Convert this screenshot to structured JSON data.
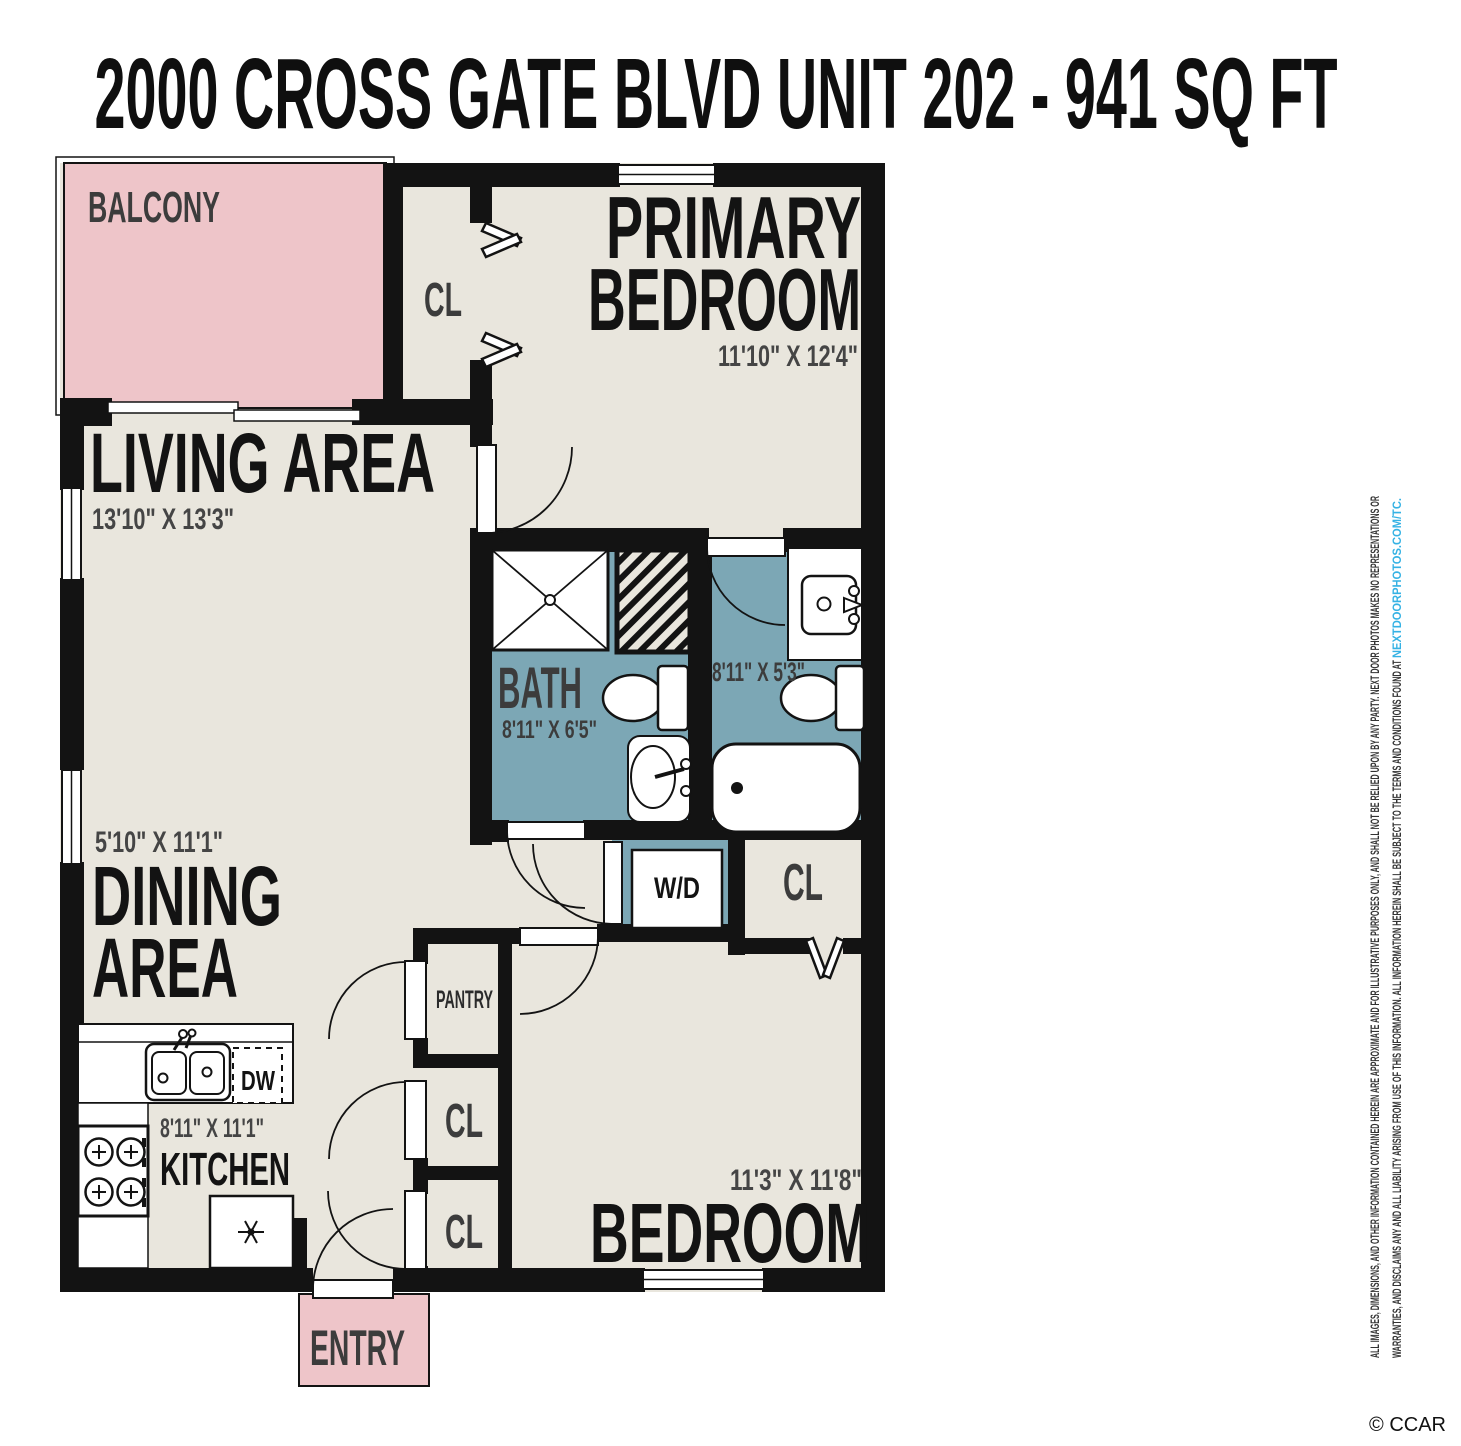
{
  "title": "2000 CROSS GATE BLVD UNIT 202 - 941 SQ FT",
  "floorplan": {
    "rooms": {
      "balcony": {
        "label": "BALCONY"
      },
      "closet_primary": {
        "label": "CL"
      },
      "primary_bedroom": {
        "line1": "PRIMARY",
        "line2": "BEDROOM",
        "dims": "11'10\" X 12'4\""
      },
      "living_area": {
        "label": "LIVING AREA",
        "dims": "13'10\" X 13'3\""
      },
      "bath": {
        "label": "BATH",
        "dims": "8'11\" X 6'5\""
      },
      "ensuite_bath": {
        "dims": "8'11\" X 5'3\""
      },
      "washer_dryer": {
        "label": "W/D"
      },
      "hall_closet": {
        "label": "CL"
      },
      "dining_area": {
        "line1": "DINING",
        "line2": "AREA",
        "dims": "5'10\" X 11'1\""
      },
      "pantry": {
        "label": "PANTRY"
      },
      "closet_1": {
        "label": "CL"
      },
      "closet_2": {
        "label": "CL"
      },
      "kitchen": {
        "label": "KITCHEN",
        "dims": "8'11\" X 11'1\""
      },
      "dishwasher": {
        "label": "DW"
      },
      "bedroom": {
        "label": "BEDROOM",
        "dims": "11'3\" X 11'8\""
      },
      "entry": {
        "label": "ENTRY"
      }
    },
    "colors": {
      "floor": "#e9e6dd",
      "wall": "#131313",
      "balcony_fill": "#eec5c9",
      "bath_fill": "#7ca7b5",
      "label_dark": "#131313",
      "label_gray": "#3c3c3c",
      "dims_gray": "#454545",
      "link_blue": "#35b2e4"
    }
  },
  "disclaimer": {
    "line1": "ALL IMAGES, DIMENSIONS, AND OTHER INFORMATION CONTAINED HEREIN ARE APPROXIMATE AND FOR ILLUSTRATIVE PURPOSES ONLY, AND SHALL NOT BE RELIED UPON BY ANY PARTY. NEXT DOOR PHOTOS MAKES NO REPRESENTATIONS OR",
    "line2_prefix": "WARRANTIES, AND DISCLAIMS ANY AND ALL LIABILITY ARISING FROM USE OF THIS INFORMATION. ALL INFORMATION HEREIN SHALL BE SUBJECT TO THE TERMS AND CONDITIONS FOUND AT ",
    "line2_link": "NEXTDOORPHOTOS.COM/TC."
  },
  "credit": "© CCAR"
}
